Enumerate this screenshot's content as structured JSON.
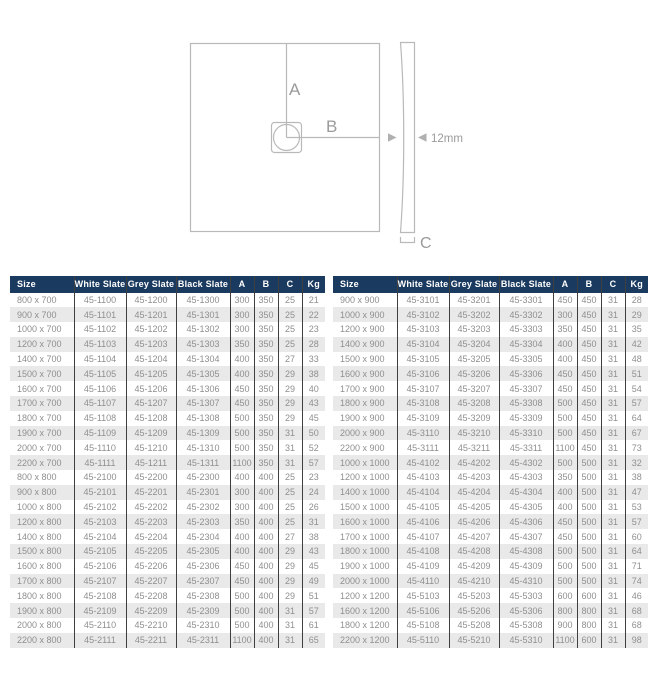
{
  "diagram": {
    "label_a": "A",
    "label_b": "B",
    "label_c": "C",
    "thickness_label": "12mm"
  },
  "tables": {
    "columns": [
      "Size",
      "White Slate",
      "Grey Slate",
      "Black Slate",
      "A",
      "B",
      "C",
      "Kg"
    ],
    "left_rows": [
      [
        "800 x 700",
        "45-1100",
        "45-1200",
        "45-1300",
        "300",
        "350",
        "25",
        "21"
      ],
      [
        "900 x 700",
        "45-1101",
        "45-1201",
        "45-1301",
        "300",
        "350",
        "25",
        "22"
      ],
      [
        "1000 x 700",
        "45-1102",
        "45-1202",
        "45-1302",
        "300",
        "350",
        "25",
        "23"
      ],
      [
        "1200 x 700",
        "45-1103",
        "45-1203",
        "45-1303",
        "350",
        "350",
        "25",
        "28"
      ],
      [
        "1400 x 700",
        "45-1104",
        "45-1204",
        "45-1304",
        "400",
        "350",
        "27",
        "33"
      ],
      [
        "1500 x 700",
        "45-1105",
        "45-1205",
        "45-1305",
        "400",
        "350",
        "29",
        "38"
      ],
      [
        "1600 x 700",
        "45-1106",
        "45-1206",
        "45-1306",
        "450",
        "350",
        "29",
        "40"
      ],
      [
        "1700 x 700",
        "45-1107",
        "45-1207",
        "45-1307",
        "450",
        "350",
        "29",
        "43"
      ],
      [
        "1800 x 700",
        "45-1108",
        "45-1208",
        "45-1308",
        "500",
        "350",
        "29",
        "45"
      ],
      [
        "1900 x 700",
        "45-1109",
        "45-1209",
        "45-1309",
        "500",
        "350",
        "31",
        "50"
      ],
      [
        "2000 x 700",
        "45-1110",
        "45-1210",
        "45-1310",
        "500",
        "350",
        "31",
        "52"
      ],
      [
        "2200 x 700",
        "45-1111",
        "45-1211",
        "45-1311",
        "1100",
        "350",
        "31",
        "57"
      ],
      [
        "800 x 800",
        "45-2100",
        "45-2200",
        "45-2300",
        "400",
        "400",
        "25",
        "23"
      ],
      [
        "900 x 800",
        "45-2101",
        "45-2201",
        "45-2301",
        "300",
        "400",
        "25",
        "24"
      ],
      [
        "1000 x 800",
        "45-2102",
        "45-2202",
        "45-2302",
        "300",
        "400",
        "25",
        "26"
      ],
      [
        "1200 x 800",
        "45-2103",
        "45-2203",
        "45-2303",
        "350",
        "400",
        "25",
        "31"
      ],
      [
        "1400 x 800",
        "45-2104",
        "45-2204",
        "45-2304",
        "400",
        "400",
        "27",
        "38"
      ],
      [
        "1500 x 800",
        "45-2105",
        "45-2205",
        "45-2305",
        "400",
        "400",
        "29",
        "43"
      ],
      [
        "1600 x 800",
        "45-2106",
        "45-2206",
        "45-2306",
        "450",
        "400",
        "29",
        "45"
      ],
      [
        "1700 x 800",
        "45-2107",
        "45-2207",
        "45-2307",
        "450",
        "400",
        "29",
        "49"
      ],
      [
        "1800 x 800",
        "45-2108",
        "45-2208",
        "45-2308",
        "500",
        "400",
        "29",
        "51"
      ],
      [
        "1900 x 800",
        "45-2109",
        "45-2209",
        "45-2309",
        "500",
        "400",
        "31",
        "57"
      ],
      [
        "2000 x 800",
        "45-2110",
        "45-2210",
        "45-2310",
        "500",
        "400",
        "31",
        "61"
      ],
      [
        "2200 x 800",
        "45-2111",
        "45-2211",
        "45-2311",
        "1100",
        "400",
        "31",
        "65"
      ]
    ],
    "right_rows": [
      [
        "900 x 900",
        "45-3101",
        "45-3201",
        "45-3301",
        "450",
        "450",
        "31",
        "28"
      ],
      [
        "1000 x 900",
        "45-3102",
        "45-3202",
        "45-3302",
        "300",
        "450",
        "31",
        "29"
      ],
      [
        "1200 x 900",
        "45-3103",
        "45-3203",
        "45-3303",
        "350",
        "450",
        "31",
        "35"
      ],
      [
        "1400 x 900",
        "45-3104",
        "45-3204",
        "45-3304",
        "400",
        "450",
        "31",
        "42"
      ],
      [
        "1500 x 900",
        "45-3105",
        "45-3205",
        "45-3305",
        "400",
        "450",
        "31",
        "48"
      ],
      [
        "1600 x 900",
        "45-3106",
        "45-3206",
        "45-3306",
        "450",
        "450",
        "31",
        "51"
      ],
      [
        "1700 x 900",
        "45-3107",
        "45-3207",
        "45-3307",
        "450",
        "450",
        "31",
        "54"
      ],
      [
        "1800 x 900",
        "45-3108",
        "45-3208",
        "45-3308",
        "500",
        "450",
        "31",
        "57"
      ],
      [
        "1900 x 900",
        "45-3109",
        "45-3209",
        "45-3309",
        "500",
        "450",
        "31",
        "64"
      ],
      [
        "2000 x 900",
        "45-3110",
        "45-3210",
        "45-3310",
        "500",
        "450",
        "31",
        "67"
      ],
      [
        "2200 x 900",
        "45-3111",
        "45-3211",
        "45-3311",
        "1100",
        "450",
        "31",
        "73"
      ],
      [
        "1000 x 1000",
        "45-4102",
        "45-4202",
        "45-4302",
        "500",
        "500",
        "31",
        "32"
      ],
      [
        "1200 x 1000",
        "45-4103",
        "45-4203",
        "45-4303",
        "350",
        "500",
        "31",
        "38"
      ],
      [
        "1400 x 1000",
        "45-4104",
        "45-4204",
        "45-4304",
        "400",
        "500",
        "31",
        "47"
      ],
      [
        "1500 x 1000",
        "45-4105",
        "45-4205",
        "45-4305",
        "400",
        "500",
        "31",
        "53"
      ],
      [
        "1600 x 1000",
        "45-4106",
        "45-4206",
        "45-4306",
        "450",
        "500",
        "31",
        "57"
      ],
      [
        "1700 x 1000",
        "45-4107",
        "45-4207",
        "45-4307",
        "450",
        "500",
        "31",
        "60"
      ],
      [
        "1800 x 1000",
        "45-4108",
        "45-4208",
        "45-4308",
        "500",
        "500",
        "31",
        "64"
      ],
      [
        "1900 x 1000",
        "45-4109",
        "45-4209",
        "45-4309",
        "500",
        "500",
        "31",
        "71"
      ],
      [
        "2000 x 1000",
        "45-4110",
        "45-4210",
        "45-4310",
        "500",
        "500",
        "31",
        "74"
      ],
      [
        "1200 x 1200",
        "45-5103",
        "45-5203",
        "45-5303",
        "600",
        "600",
        "31",
        "46"
      ],
      [
        "1600 x 1200",
        "45-5106",
        "45-5206",
        "45-5306",
        "800",
        "800",
        "31",
        "68"
      ],
      [
        "1800 x 1200",
        "45-5108",
        "45-5208",
        "45-5308",
        "900",
        "800",
        "31",
        "68"
      ],
      [
        "2200 x 1200",
        "45-5110",
        "45-5210",
        "45-5310",
        "1100",
        "600",
        "31",
        "98"
      ]
    ]
  },
  "colors": {
    "header_bg": "#1b3a5f",
    "header_text": "#ffffff",
    "row_stripe": "#e9e9e9",
    "body_text": "#8f8f8f",
    "column_border": "#3f3f3f",
    "diagram_line": "#b9b9b9",
    "diagram_text": "#9b9b9b"
  }
}
